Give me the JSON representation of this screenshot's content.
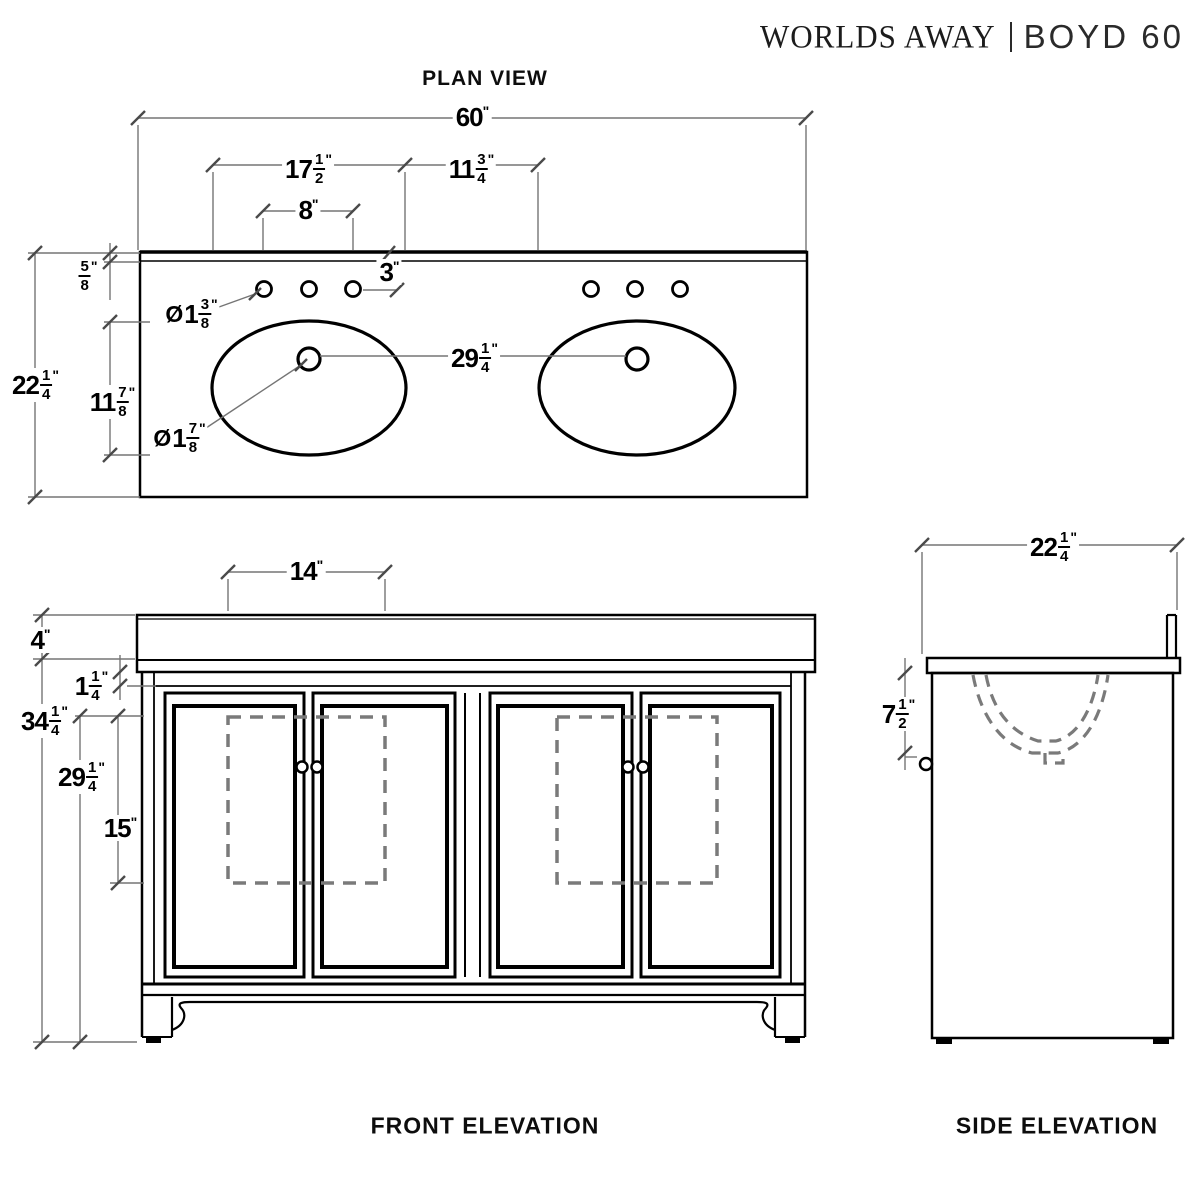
{
  "header": {
    "brand": "WORLDS AWAY",
    "separator": "|",
    "product": "BOYD 60"
  },
  "views": {
    "plan": {
      "title": "PLAN VIEW"
    },
    "front": {
      "title": "FRONT ELEVATION"
    },
    "side": {
      "title": "SIDE ELEVATION"
    }
  },
  "dimensions": {
    "plan": {
      "overall_width": {
        "whole": "60",
        "unit": "\""
      },
      "sink_cutout_width": {
        "whole": "17",
        "num": "1",
        "den": "2",
        "unit": "\""
      },
      "sink_gap": {
        "whole": "11",
        "num": "3",
        "den": "4",
        "unit": "\""
      },
      "faucet_spread": {
        "whole": "8",
        "unit": "\""
      },
      "faucet_offset": {
        "whole": "3",
        "unit": "\""
      },
      "counter_edge": {
        "num": "5",
        "den": "8",
        "unit": "\""
      },
      "overall_depth": {
        "whole": "22",
        "num": "1",
        "den": "4",
        "unit": "\""
      },
      "sink_cutout_depth": {
        "whole": "11",
        "num": "7",
        "den": "8",
        "unit": "\""
      },
      "drain_spacing": {
        "whole": "29",
        "num": "1",
        "den": "4",
        "unit": "\""
      },
      "faucet_hole_dia": {
        "prefix": "Ø",
        "whole": "1",
        "num": "3",
        "den": "8",
        "unit": "\""
      },
      "drain_hole_dia": {
        "prefix": "Ø",
        "whole": "1",
        "num": "7",
        "den": "8",
        "unit": "\""
      }
    },
    "front": {
      "counter_height": {
        "whole": "4",
        "unit": "\""
      },
      "top_rail_height": {
        "whole": "1",
        "num": "1",
        "den": "4",
        "unit": "\""
      },
      "cabinet_height": {
        "whole": "34",
        "num": "1",
        "den": "4",
        "unit": "\""
      },
      "opening_height": {
        "whole": "29",
        "num": "1",
        "den": "4",
        "unit": "\""
      },
      "panel_height": {
        "whole": "15",
        "unit": "\""
      },
      "panel_width": {
        "whole": "14",
        "unit": "\""
      }
    },
    "side": {
      "overall_depth": {
        "whole": "22",
        "num": "1",
        "den": "4",
        "unit": "\""
      },
      "bowl_depth": {
        "whole": "7",
        "num": "1",
        "den": "2",
        "unit": "\""
      }
    }
  },
  "colors": {
    "object_line": "#000000",
    "dimension_line": "#757575",
    "hidden_line": "#7a7a7a",
    "background": "#ffffff"
  }
}
